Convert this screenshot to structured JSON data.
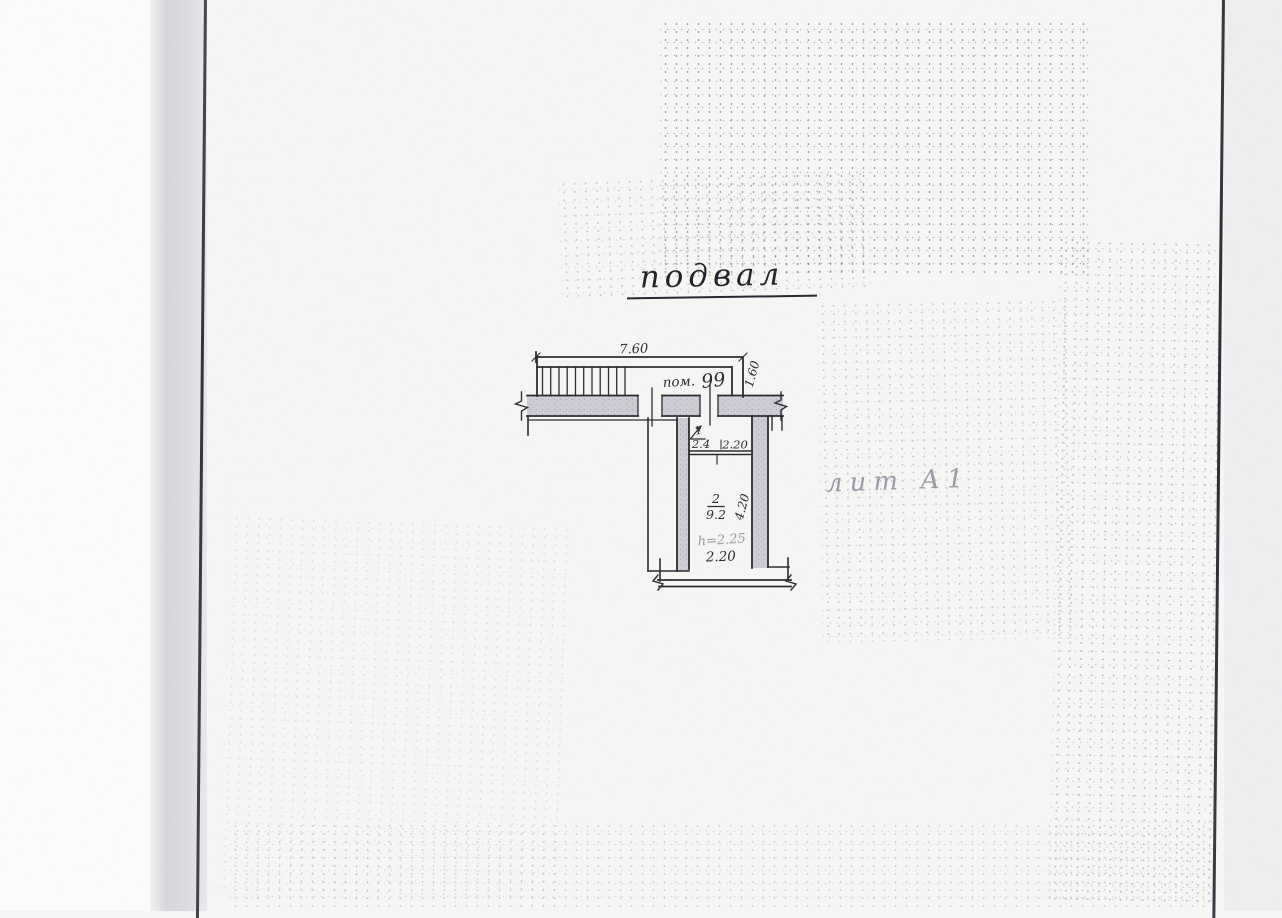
{
  "document": {
    "title": "подвал",
    "annotation_lit": "лит А1",
    "plan": {
      "corridor": {
        "label_prefix": "пом.",
        "room_number": "99",
        "top_dim": "7.60",
        "side_dim": "1.60"
      },
      "room1": {
        "number": "1",
        "area": "2.4",
        "width_dim": "2.20"
      },
      "room2": {
        "number": "2",
        "area": "9.2",
        "depth_dim": "4.20",
        "height_note": "h=2.25",
        "width_dim": "2.20"
      }
    },
    "colors": {
      "ink": "#2e2c33",
      "pencil": "#9d99a8",
      "wall_fill": "#cfccd4",
      "page": "#f6f5f3",
      "fold_line": "#36343d"
    }
  }
}
